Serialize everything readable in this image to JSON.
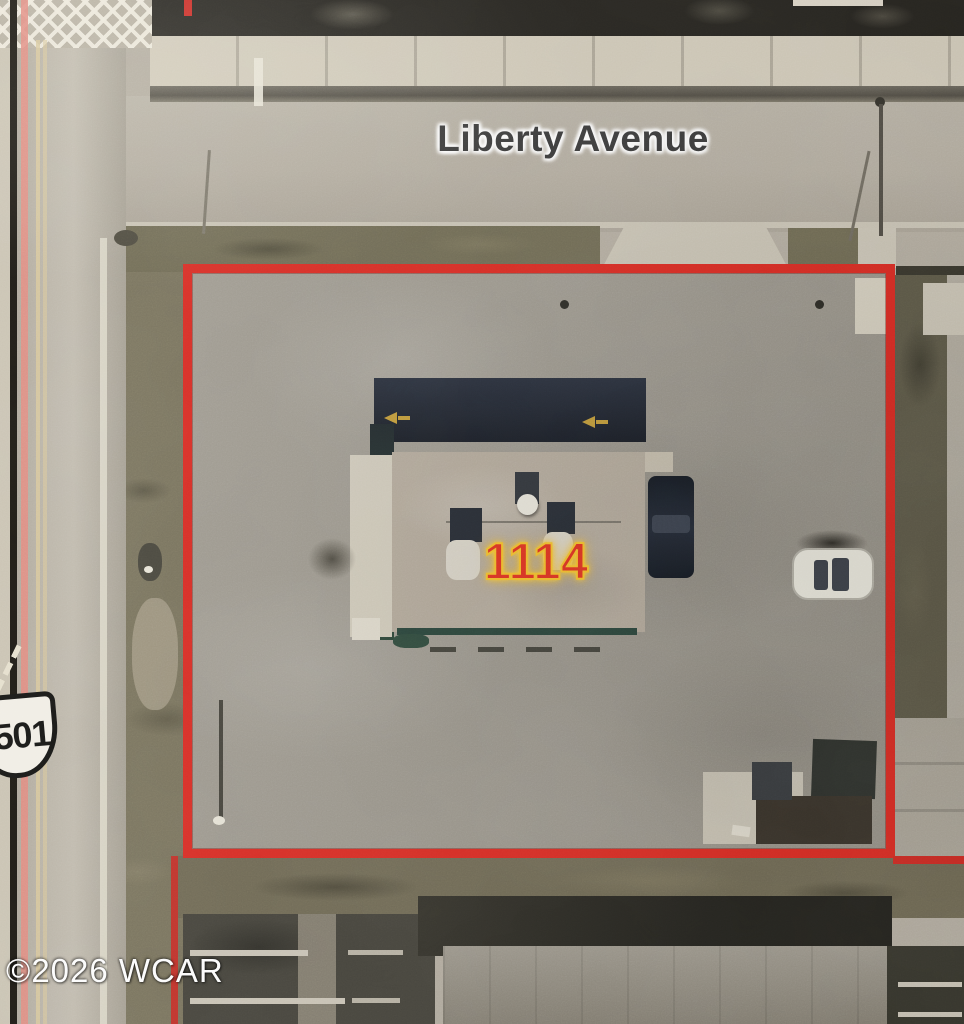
{
  "map": {
    "street_label": "Liberty Avenue",
    "parcel_number": "1114",
    "route_shield_number": "501",
    "watermark": "©2026 WCAR",
    "colors": {
      "parcel_boundary_red": "#d92a22",
      "parcel_number_red": "#e13320",
      "parcel_number_glow_yellow": "#f6c12c",
      "street_label_dark": "#3a3a3a",
      "watermark_white": "#ffffff",
      "property_line_pink": "#e18a7e",
      "property_line_black": "#17140e"
    }
  }
}
